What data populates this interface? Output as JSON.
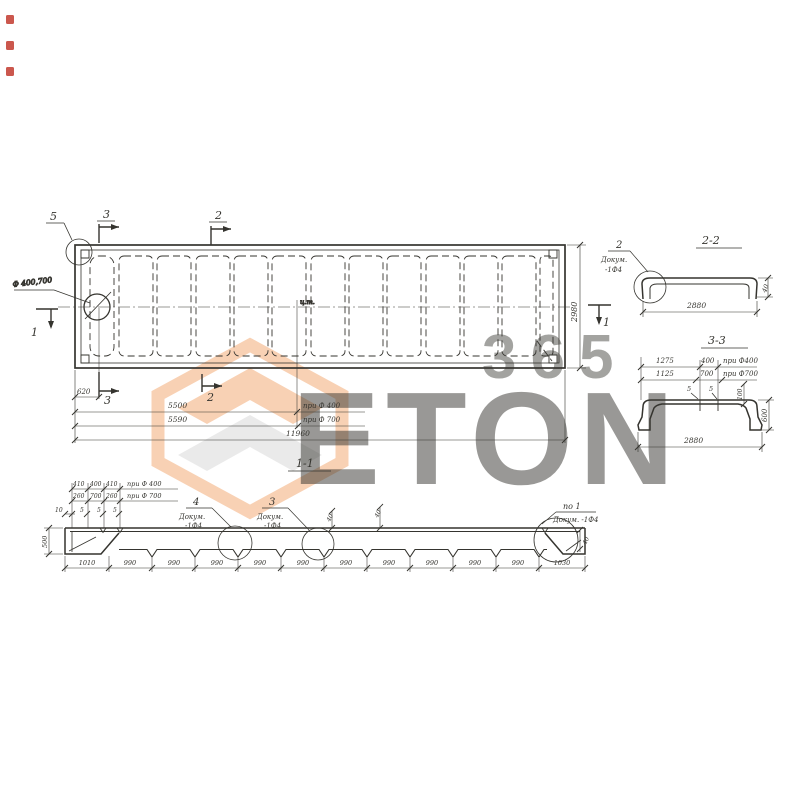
{
  "watermark": {
    "brand": "ETON",
    "number": "365",
    "orange": "#f0924e",
    "gray": "#c6c6c6"
  },
  "plan": {
    "marker_5": "5",
    "marker_3": "3",
    "marker_2": "2",
    "marker_1": "1",
    "hole_label": "Ф 400,700",
    "ct_label": "ц.т.",
    "dim_height": "2980",
    "dim_620": "620",
    "dim_5500": "5500",
    "note_5500": "при Ф 400",
    "dim_5590": "5590",
    "note_5590": "при Ф 700",
    "dim_total": "11960"
  },
  "section22": {
    "title": "2-2",
    "callout_num": "2",
    "callout_doc": "Докум.",
    "callout_ref": "-1Ф4",
    "dim_width": "2880",
    "dim_thickness": "40"
  },
  "section33": {
    "title": "3-3",
    "dim_1275": "1275",
    "dim_400": "400",
    "note_400": "при Ф400",
    "dim_1125": "1125",
    "dim_700": "700",
    "note_700": "при Ф700",
    "dim_5a": "5",
    "dim_5b": "5",
    "dim_100": "100",
    "dim_height": "600",
    "dim_width": "2880"
  },
  "section11": {
    "title": "1-1",
    "row400": [
      "410",
      "400",
      "410"
    ],
    "note400": "при Ф 400",
    "row700": [
      "260",
      "700",
      "260"
    ],
    "note700": "при Ф 700",
    "small": [
      "10",
      "5",
      "5",
      "5"
    ],
    "dim_left_height": "500",
    "dim_40a": "40",
    "dim_40b": "40",
    "dim_40c": "40",
    "callout4_num": "4",
    "callout4_doc": "Докум.",
    "callout4_ref": "-1Ф4",
    "callout3_num": "3",
    "callout3_doc": "Докум.",
    "callout3_ref": "-1Ф4",
    "callout_po1_num": "по 1",
    "callout_po1_doc": "Докум. -1Ф4",
    "bottom_dims": [
      "1010",
      "990",
      "990",
      "990",
      "990",
      "990",
      "990",
      "990",
      "990",
      "990",
      "990",
      "1030"
    ]
  }
}
